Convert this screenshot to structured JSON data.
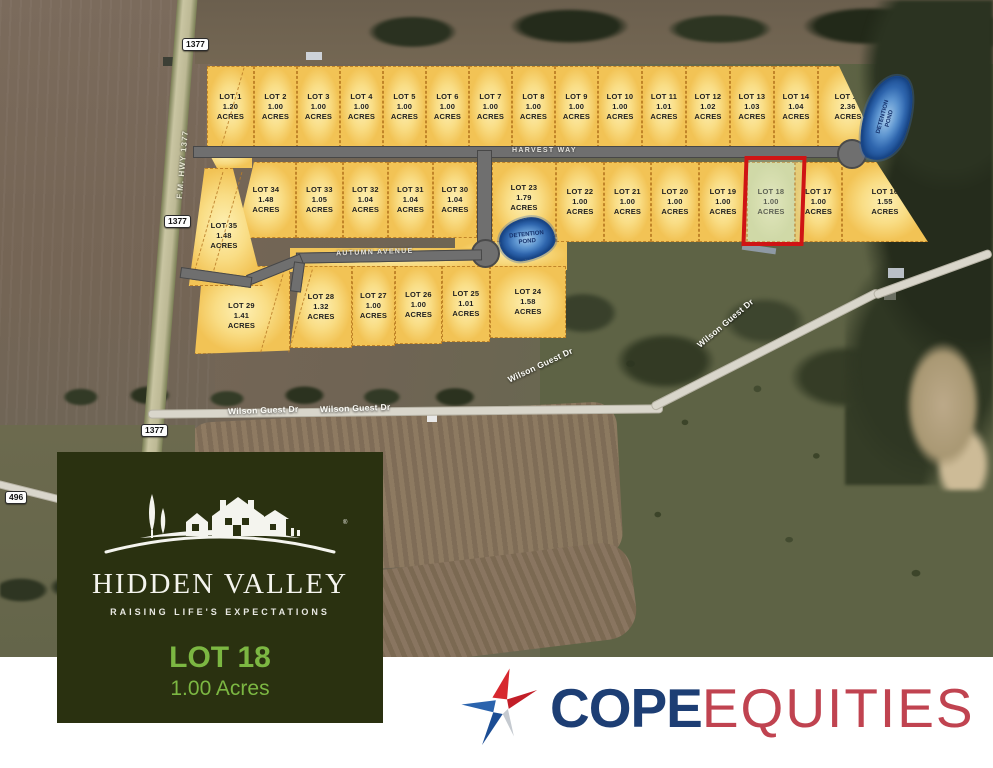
{
  "map": {
    "lot_word": "LOT",
    "acres_word": "ACRES",
    "streets": [
      {
        "name": "HARVEST WAY",
        "cls": "road-label",
        "x": 512,
        "y": 147,
        "rot": 0
      },
      {
        "name": "AUTUMN AVENUE",
        "cls": "road-label",
        "x": 336,
        "y": 249,
        "rot": -2
      },
      {
        "name": "F.M. HWY 1377",
        "cls": "hwy-label",
        "x": 148,
        "y": 160,
        "rot": -85
      },
      {
        "name": "Wilson Guest Dr",
        "cls": "wilson-label",
        "x": 228,
        "y": 405,
        "rot": -2
      },
      {
        "name": "Wilson Guest Dr",
        "cls": "wilson-label",
        "x": 320,
        "y": 403,
        "rot": -2
      },
      {
        "name": "Wilson Guest Dr",
        "cls": "wilson-label",
        "x": 505,
        "y": 360,
        "rot": -25
      },
      {
        "name": "Wilson Guest Dr",
        "cls": "wilson-label",
        "x": 690,
        "y": 318,
        "rot": -40
      }
    ],
    "badges": [
      {
        "label": "1377",
        "x": 182,
        "y": 38
      },
      {
        "label": "1377",
        "x": 164,
        "y": 215
      },
      {
        "label": "1377",
        "x": 141,
        "y": 424
      },
      {
        "label": "496",
        "x": 5,
        "y": 491
      }
    ],
    "ponds": [
      {
        "label": "DETENTION POND",
        "x": 864,
        "y": 74,
        "w": 46,
        "h": 88,
        "rot": 18,
        "text_rot": -75,
        "text_w": 36
      },
      {
        "label": "DETENTION POND",
        "x": 499,
        "y": 218,
        "w": 56,
        "h": 42,
        "rot": -12,
        "text_rot": -6,
        "text_w": 42
      }
    ],
    "highlight_lot": "LOT 18",
    "highlight_color": "#cf1414",
    "lots": [
      {
        "id": 1,
        "acres": "1.20",
        "x": 207,
        "y": 66,
        "w": 47,
        "h": 82
      },
      {
        "id": 2,
        "acres": "1.00",
        "x": 254,
        "y": 66,
        "w": 43,
        "h": 82
      },
      {
        "id": 3,
        "acres": "1.00",
        "x": 297,
        "y": 66,
        "w": 43,
        "h": 82
      },
      {
        "id": 4,
        "acres": "1.00",
        "x": 340,
        "y": 66,
        "w": 43,
        "h": 82
      },
      {
        "id": 5,
        "acres": "1.00",
        "x": 383,
        "y": 66,
        "w": 43,
        "h": 82
      },
      {
        "id": 6,
        "acres": "1.00",
        "x": 426,
        "y": 66,
        "w": 43,
        "h": 82
      },
      {
        "id": 7,
        "acres": "1.00",
        "x": 469,
        "y": 66,
        "w": 43,
        "h": 82
      },
      {
        "id": 8,
        "acres": "1.00",
        "x": 512,
        "y": 66,
        "w": 43,
        "h": 82
      },
      {
        "id": 9,
        "acres": "1.00",
        "x": 555,
        "y": 66,
        "w": 43,
        "h": 82
      },
      {
        "id": 10,
        "acres": "1.00",
        "x": 598,
        "y": 66,
        "w": 44,
        "h": 82
      },
      {
        "id": 11,
        "acres": "1.01",
        "x": 642,
        "y": 66,
        "w": 44,
        "h": 82
      },
      {
        "id": 12,
        "acres": "1.02",
        "x": 686,
        "y": 66,
        "w": 44,
        "h": 82
      },
      {
        "id": 13,
        "acres": "1.03",
        "x": 730,
        "y": 66,
        "w": 44,
        "h": 82
      },
      {
        "id": 14,
        "acres": "1.04",
        "x": 774,
        "y": 66,
        "w": 44,
        "h": 82
      },
      {
        "id": 15,
        "acres": "2.36",
        "x": 818,
        "y": 66,
        "w": 60,
        "h": 82,
        "clip": "polygon(0 0, 35% 0, 100% 100%, 0 100%)"
      },
      {
        "id": 16,
        "acres": "1.55",
        "x": 842,
        "y": 162,
        "w": 86,
        "h": 80,
        "clip": "polygon(0 0, 40% 0, 100% 100%, 0 100%)"
      },
      {
        "id": 17,
        "acres": "1.00",
        "x": 795,
        "y": 162,
        "w": 47,
        "h": 80
      },
      {
        "id": 18,
        "acres": "1.00",
        "x": 747,
        "y": 162,
        "w": 48,
        "h": 80,
        "hl": true
      },
      {
        "id": 19,
        "acres": "1.00",
        "x": 699,
        "y": 162,
        "w": 48,
        "h": 80
      },
      {
        "id": 20,
        "acres": "1.00",
        "x": 651,
        "y": 162,
        "w": 48,
        "h": 80
      },
      {
        "id": 21,
        "acres": "1.00",
        "x": 604,
        "y": 162,
        "w": 47,
        "h": 80
      },
      {
        "id": 22,
        "acres": "1.00",
        "x": 556,
        "y": 162,
        "w": 48,
        "h": 80
      },
      {
        "id": 23,
        "acres": "1.79",
        "x": 492,
        "y": 162,
        "w": 64,
        "h": 80,
        "dy": -8
      },
      {
        "id": 24,
        "acres": "1.58",
        "x": 490,
        "y": 266,
        "w": 76,
        "h": 72
      },
      {
        "id": 25,
        "acres": "1.01",
        "x": 442,
        "y": 266,
        "w": 48,
        "h": 76
      },
      {
        "id": 26,
        "acres": "1.00",
        "x": 395,
        "y": 266,
        "w": 47,
        "h": 78
      },
      {
        "id": 27,
        "acres": "1.00",
        "x": 352,
        "y": 266,
        "w": 43,
        "h": 80
      },
      {
        "id": 28,
        "acres": "1.32",
        "x": 290,
        "y": 266,
        "w": 62,
        "h": 82,
        "clip": "polygon(18% 0, 100% 0, 100% 100%, 0 100%)"
      },
      {
        "id": 29,
        "acres": "1.41",
        "x": 193,
        "y": 266,
        "w": 97,
        "h": 88,
        "dy": 12,
        "clip": "polygon(10% 0, 100% 0, 100% 96%, 2% 100%)"
      },
      {
        "id": 30,
        "acres": "1.04",
        "x": 433,
        "y": 162,
        "w": 44,
        "h": 76
      },
      {
        "id": 31,
        "acres": "1.04",
        "x": 388,
        "y": 162,
        "w": 45,
        "h": 76
      },
      {
        "id": 32,
        "acres": "1.04",
        "x": 343,
        "y": 162,
        "w": 45,
        "h": 76
      },
      {
        "id": 33,
        "acres": "1.05",
        "x": 296,
        "y": 162,
        "w": 47,
        "h": 76
      },
      {
        "id": 34,
        "acres": "1.48",
        "x": 236,
        "y": 162,
        "w": 60,
        "h": 76,
        "clip": "polygon(30% 0, 100% 0, 100% 100%, 0 100%)"
      },
      {
        "id": 35,
        "acres": "1.48",
        "x": 180,
        "y": 168,
        "w": 88,
        "h": 118,
        "dy": 18,
        "clip": "polygon(28% 0, 60% 0, 94% 100%, 10% 100%)"
      }
    ]
  },
  "panel": {
    "brand": "HIDDEN VALLEY",
    "tagline": "RAISING LIFE'S EXPECTATIONS",
    "lot_title": "LOT 18",
    "lot_acres": "1.00 Acres",
    "reg_mark": "®"
  },
  "footer": {
    "brand_primary": "COPE",
    "brand_secondary": "EQUITIES"
  }
}
